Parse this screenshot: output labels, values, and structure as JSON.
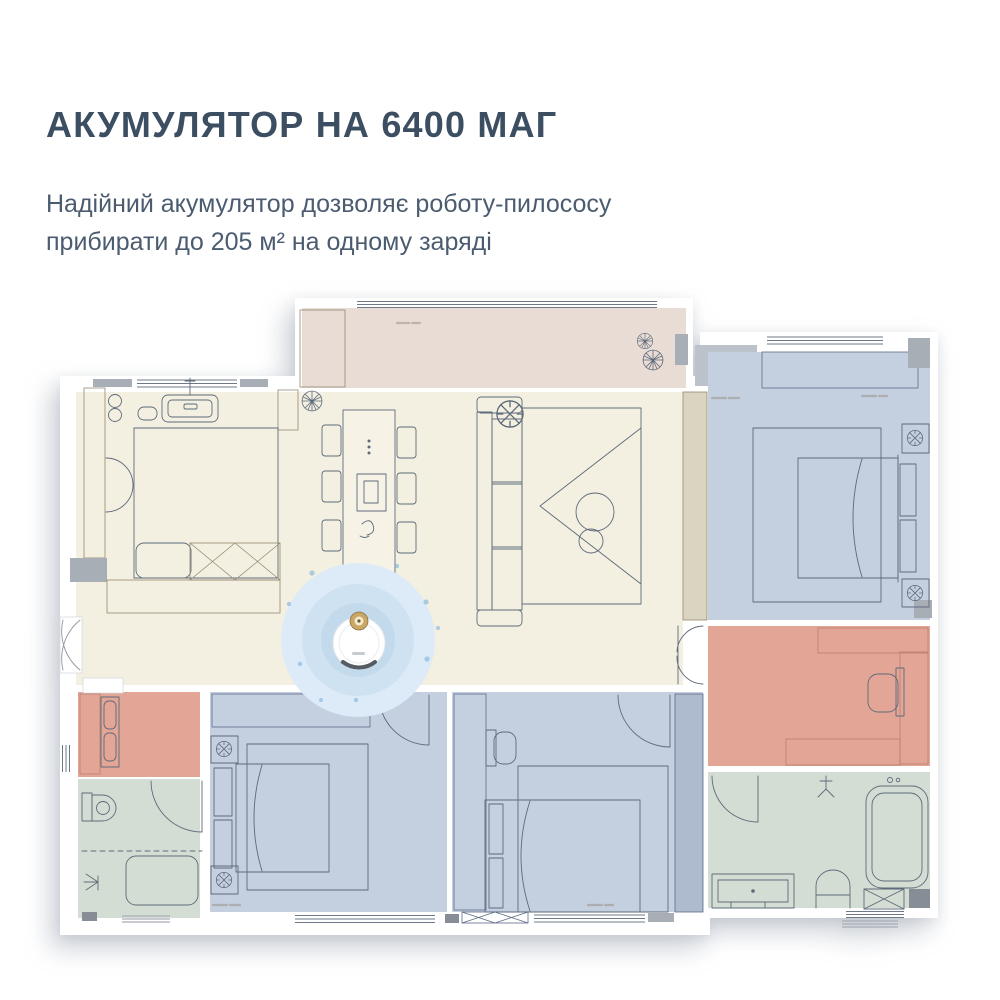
{
  "header": {
    "title": "АКУМУЛЯТОР НА 6400 МАГ",
    "subtitle_line1": "Надійний акумулятор дозволяє роботу-пилососу",
    "subtitle_line2": "прибирати до 205 м² на одному заряді"
  },
  "colors": {
    "background": "#ffffff",
    "title": "#3c4e62",
    "subtitle": "#4b5c70",
    "wall": "#ffffff",
    "wall_accent": "#a8aeb6",
    "wall_accent_dark": "#878d96",
    "wall_block": "#bcc2ca",
    "floor_cream": "#f3f0e1",
    "floor_balcony": "#e9dcd5",
    "floor_blue": "#c4cfe0",
    "floor_blue_deep": "#aebacf",
    "floor_salmon": "#e2a596",
    "floor_green": "#d4ddd3",
    "floor_wardrobe": "#d9d5c0",
    "island": "#f6f3e6",
    "line": "#5e6a7a",
    "line_tan": "#95896f",
    "line_blue": "#5d6b85",
    "line_salmon": "#b97f6f",
    "line_window": "#6e7888",
    "label_dash": "#9b9488",
    "ring_outer": "#dcebf7",
    "ring_mid": "#cfe2f2",
    "ring_inner": "#c3daed",
    "robot_body": "#ffffff",
    "robot_turret": "#c9a765",
    "robot_turret_inner": "#f4ecd2",
    "dot_blue": "#85b7dc"
  }
}
